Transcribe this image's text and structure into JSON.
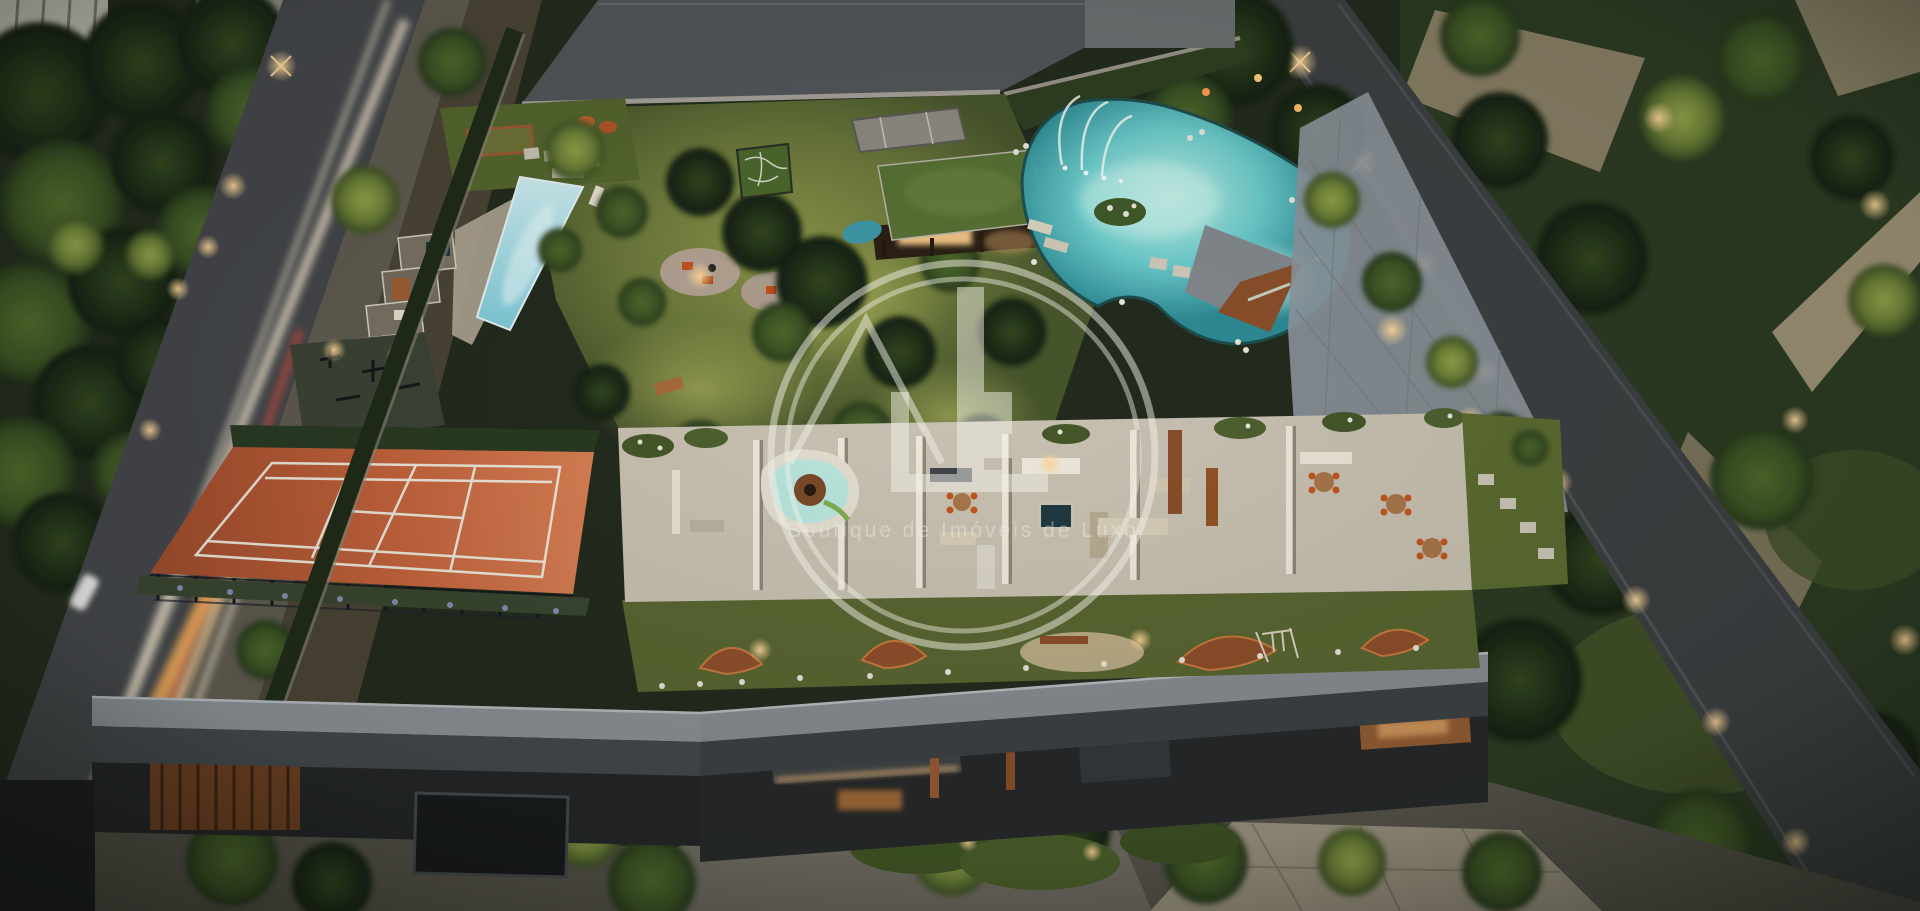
{
  "scene": {
    "type": "aerial-architectural-rendering",
    "time_of_day": "dusk",
    "description": "Aerial dusk rendering of a luxury residential condominium block: rooftop leisure terrace with spas and dining areas, lap pool with cabanas, open-air gym, clay tennis court, central lawn, green-roof pavilion, natural lagoon pool with fountain jets, corten play sculptures, tree-lined streets with car light trails and a lit neighborhood park."
  },
  "watermark": {
    "monogram": "JL",
    "tagline": "Boutique de Imóveis de Luxo",
    "color": "#F2EFE7"
  },
  "palette": {
    "dusk_shadow": "#232B1E",
    "lawn": "#6E7A3C",
    "lawn_lit": "#9AA351",
    "tree_dark": "#1D2A17",
    "tree_mid": "#3A5124",
    "tree_lit": "#6D8038",
    "lap_pool": "#9FDBE4",
    "lagoon": "#6FD2D2",
    "lagoon_glow": "#BEF2E8",
    "clay_court": "#C4633C",
    "court_line": "#EFE8DC",
    "concrete": "#C9C2B2",
    "paver": "#979FA6",
    "corten": "#9A5A33",
    "wood": "#A96A3C",
    "green_roof": "#567134",
    "asphalt": "#44464A",
    "parapet": "#8B9196",
    "facade": "#26282A",
    "warm_light": "#FFC979",
    "light_trail_red": "#FF6A45",
    "blossom": "#E9E6DC",
    "watermark": "#F2EFE7"
  },
  "regions": [
    {
      "id": "left-street",
      "label": "Tree-lined street with car light trails"
    },
    {
      "id": "lap-pool",
      "label": "Lap pool with cabanas and loungers"
    },
    {
      "id": "outdoor-gym",
      "label": "Open-air gym"
    },
    {
      "id": "spa-block",
      "label": "Sauna and cold plunge block"
    },
    {
      "id": "tennis-court",
      "label": "Clay tennis court with fence"
    },
    {
      "id": "central-lawn",
      "label": "Central garden lawn with gravel patios"
    },
    {
      "id": "garden-pavilion",
      "label": "Green-roof garden pavilion"
    },
    {
      "id": "lagoon-pool",
      "label": "Natural lagoon pool with fountain jets"
    },
    {
      "id": "mini-court",
      "label": "Kids mini sports court"
    },
    {
      "id": "boulevard",
      "label": "Paved garden boulevard"
    },
    {
      "id": "rooftop-terrace",
      "label": "Rooftop amenity terrace"
    },
    {
      "id": "play-garden",
      "label": "Corten play sculpture garden"
    },
    {
      "id": "street-level",
      "label": "Street-level entrance, garage and driveway"
    },
    {
      "id": "right-street",
      "label": "Right perimeter street with lamps"
    },
    {
      "id": "right-park",
      "label": "Neighborhood park with lit paths"
    }
  ]
}
